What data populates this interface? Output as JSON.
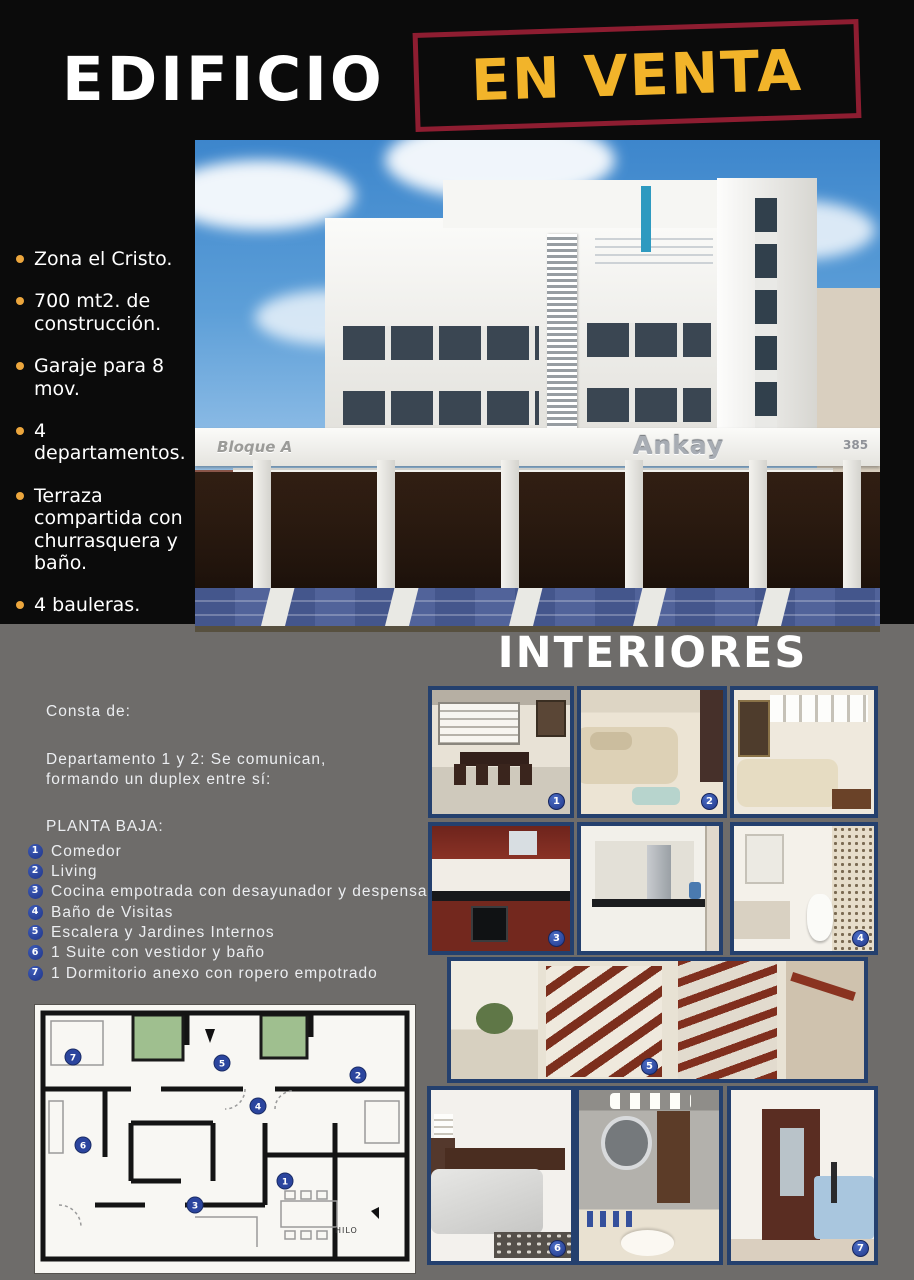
{
  "header": {
    "title": "EDIFICIO",
    "badge": "EN VENTA"
  },
  "features": {
    "items": [
      {
        "text": "Zona el Cristo."
      },
      {
        "text": "700 mt2. de construcción."
      },
      {
        "text": "Garaje para 8 mov."
      },
      {
        "text": "4 departamentos."
      },
      {
        "text": "Terraza compartida con churrasquera y baño."
      },
      {
        "text": "4 bauleras."
      }
    ]
  },
  "building_photo": {
    "block_label": "Bloque A",
    "sign": "Ankay",
    "number": "385"
  },
  "interiors": {
    "title": "INTERIORES",
    "photo_badges": [
      {
        "n": "1"
      },
      {
        "n": "2"
      },
      {
        "n": "3"
      },
      {
        "n": "4"
      },
      {
        "n": "5"
      },
      {
        "n": "6"
      },
      {
        "n": "7"
      }
    ]
  },
  "description": {
    "intro": "Consta de:",
    "line1": "Departamento 1 y 2:  Se comunican,",
    "line2": "formando un duplex entre sí:",
    "section": "PLANTA BAJA:",
    "items": [
      {
        "n": "1",
        "text": "Comedor"
      },
      {
        "n": "2",
        "text": "Living"
      },
      {
        "n": "3",
        "text": "Cocina empotrada con desayunador y despensa"
      },
      {
        "n": "4",
        "text": "Baño de Visitas"
      },
      {
        "n": "5",
        "text": "Escalera y Jardines Internos"
      },
      {
        "n": "6",
        "text": "1 Suite con vestidor y baño"
      },
      {
        "n": "7",
        "text": "1 Dormitorio anexo con ropero empotrado"
      }
    ]
  },
  "floorplan": {
    "badges": [
      {
        "n": "7"
      },
      {
        "n": "5"
      },
      {
        "n": "2"
      },
      {
        "n": "4"
      },
      {
        "n": "6"
      },
      {
        "n": "3"
      },
      {
        "n": "1"
      }
    ],
    "note": "HILO"
  },
  "colors": {
    "accent_yellow": "#f2b42a",
    "box_red": "#8e1d31",
    "photo_border": "#24406e",
    "badge_blue": "#2c4da3",
    "background_gray": "#6e6c6a",
    "background_black": "#0b0b0b"
  }
}
